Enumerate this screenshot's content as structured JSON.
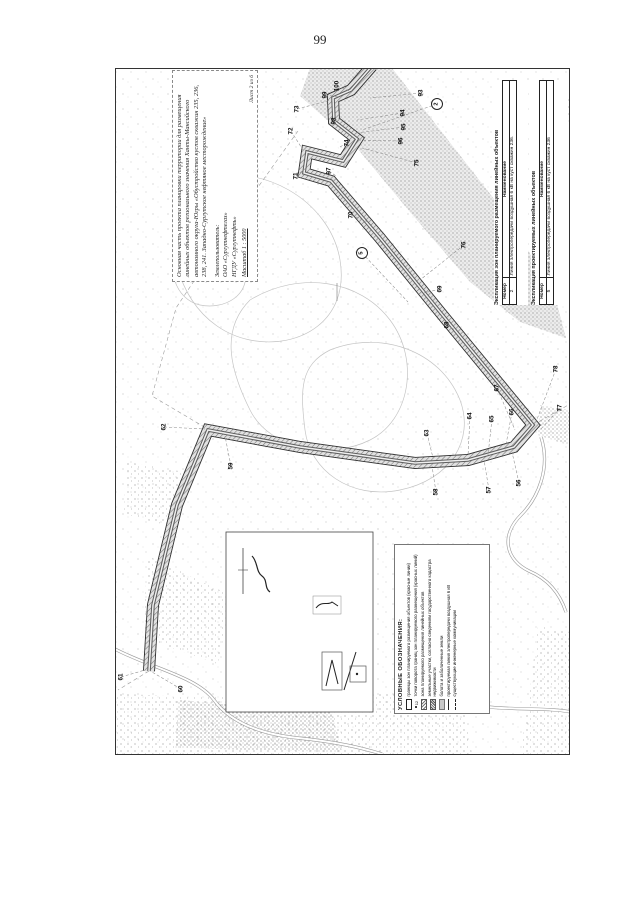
{
  "page": {
    "number": "99"
  },
  "title_block": {
    "title": "Основная часть проекта планировки территории для размещения линейных объектов регионального значения Ханты-Мансийского автономного округа-Югры «Обустройство кустов скважин 235, 236, 238, 241. Западно-Сургутское нефтяное месторождение»",
    "landuser_label": "Землепользователь:",
    "landuser_org": "ОАО «Сургутнефтегаз»",
    "landuser_dept": "НГДУ «Сургутнефть»",
    "scale": "Масштаб 1 : 5000",
    "sheet": "Лист 2 из 6"
  },
  "explication_tables": [
    {
      "title": "Экспликация зон планируемого размещения линейных объектов",
      "col_number": "Номер",
      "col_name": "Наименование",
      "rows": [
        {
          "number": "2",
          "name": "Линия электропередачи воздушная 6 кВ на куст скважин 236."
        }
      ]
    },
    {
      "title": "Экспликация проектируемых линейных объектов",
      "col_number": "Номер",
      "col_name": "Наименование",
      "rows": [
        {
          "number": "5",
          "name": "Линия электропередачи воздушная 6 кВ на куст скважин 236"
        }
      ]
    }
  ],
  "legend": {
    "title": "УСЛОВНЫЕ ОБОЗНАЧЕНИЯ:",
    "items": [
      {
        "label": "границы зон планируемого размещения объектов (красные линии)",
        "symbol": "rect-outline"
      },
      {
        "label": "точки поворота границ зон планируемого размещения (красных линий)",
        "symbol": "point-number",
        "symbol_text": "12"
      },
      {
        "label": "зона планируемого размещения линейных объектов",
        "symbol": "hatch"
      },
      {
        "label": "земельные участки, согласно сведениям государственного кадастра недвижимости",
        "symbol": "dense-hatch"
      },
      {
        "label": "болота и заболоченные земли",
        "symbol": "gray"
      },
      {
        "label": "проектируемая линия электропередачи воздушная 6 кВ",
        "symbol": "solid-line"
      },
      {
        "label": "существующие инженерные коммуникации",
        "symbol": "dashed-line"
      }
    ]
  },
  "map": {
    "point_labels": [
      {
        "text": "100",
        "x": 337,
        "y": 86,
        "tx": 352,
        "ty": 92
      },
      {
        "text": "99",
        "x": 325,
        "y": 95,
        "tx": 340,
        "ty": 97
      },
      {
        "text": "98",
        "x": 334,
        "y": 121,
        "tx": 339,
        "ty": 118
      },
      {
        "text": "73",
        "x": 297,
        "y": 109,
        "tx": 331,
        "ty": 100
      },
      {
        "text": "72",
        "x": 291,
        "y": 131,
        "tx": 303,
        "ty": 150
      },
      {
        "text": "93",
        "x": 421,
        "y": 93,
        "tx": 370,
        "ty": 98
      },
      {
        "text": "94",
        "x": 403,
        "y": 113,
        "tx": 357,
        "ty": 120
      },
      {
        "text": "95",
        "x": 404,
        "y": 127,
        "tx": 356,
        "ty": 133
      },
      {
        "text": "96",
        "x": 401,
        "y": 141,
        "tx": 358,
        "ty": 140
      },
      {
        "text": "74",
        "x": 347,
        "y": 143,
        "tx": 338,
        "ty": 148
      },
      {
        "text": "71",
        "x": 296,
        "y": 176,
        "tx": 306,
        "ty": 168
      },
      {
        "text": "97",
        "x": 329,
        "y": 171,
        "tx": 336,
        "ty": 176
      },
      {
        "text": "75",
        "x": 417,
        "y": 163,
        "tx": 362,
        "ty": 148
      },
      {
        "text": "70",
        "x": 351,
        "y": 215,
        "tx": 368,
        "ty": 222
      },
      {
        "text": "76",
        "x": 464,
        "y": 245,
        "tx": 420,
        "ty": 280
      },
      {
        "text": "69",
        "x": 440,
        "y": 289,
        "tx": 424,
        "ty": 293
      },
      {
        "text": "68",
        "x": 447,
        "y": 325,
        "tx": 455,
        "ty": 330
      },
      {
        "text": "78",
        "x": 556,
        "y": 369,
        "tx": 536,
        "ty": 422
      },
      {
        "text": "77",
        "x": 560,
        "y": 408,
        "tx": 540,
        "ty": 430
      },
      {
        "text": "67",
        "x": 497,
        "y": 388,
        "tx": 515,
        "ty": 430
      },
      {
        "text": "66",
        "x": 512,
        "y": 412,
        "tx": 505,
        "ty": 450
      },
      {
        "text": "65",
        "x": 492,
        "y": 419,
        "tx": 488,
        "ty": 455
      },
      {
        "text": "64",
        "x": 470,
        "y": 416,
        "tx": 468,
        "ty": 456
      },
      {
        "text": "63",
        "x": 427,
        "y": 433,
        "tx": 433,
        "ty": 458
      },
      {
        "text": "62",
        "x": 164,
        "y": 427,
        "tx": 205,
        "ty": 429
      },
      {
        "text": "59",
        "x": 231,
        "y": 466,
        "tx": 225,
        "ty": 436
      },
      {
        "text": "58",
        "x": 436,
        "y": 492,
        "tx": 432,
        "ty": 466
      },
      {
        "text": "57",
        "x": 489,
        "y": 490,
        "tx": 484,
        "ty": 460
      },
      {
        "text": "56",
        "x": 519,
        "y": 483,
        "tx": 512,
        "ty": 452
      },
      {
        "text": "61",
        "x": 121,
        "y": 677,
        "tx": 145,
        "ty": 670
      },
      {
        "text": "60",
        "x": 181,
        "y": 689,
        "tx": 152,
        "ty": 672
      }
    ],
    "ref_markers": [
      {
        "text": "2",
        "x": 437,
        "y": 104,
        "tx": 362,
        "ty": 130
      },
      {
        "text": "5",
        "x": 362,
        "y": 253,
        "tx": 408,
        "ty": 302
      }
    ]
  },
  "colors": {
    "ink": "#1a1a1a",
    "stipple": "#8a8a8a",
    "band_hatch": "#777777"
  }
}
